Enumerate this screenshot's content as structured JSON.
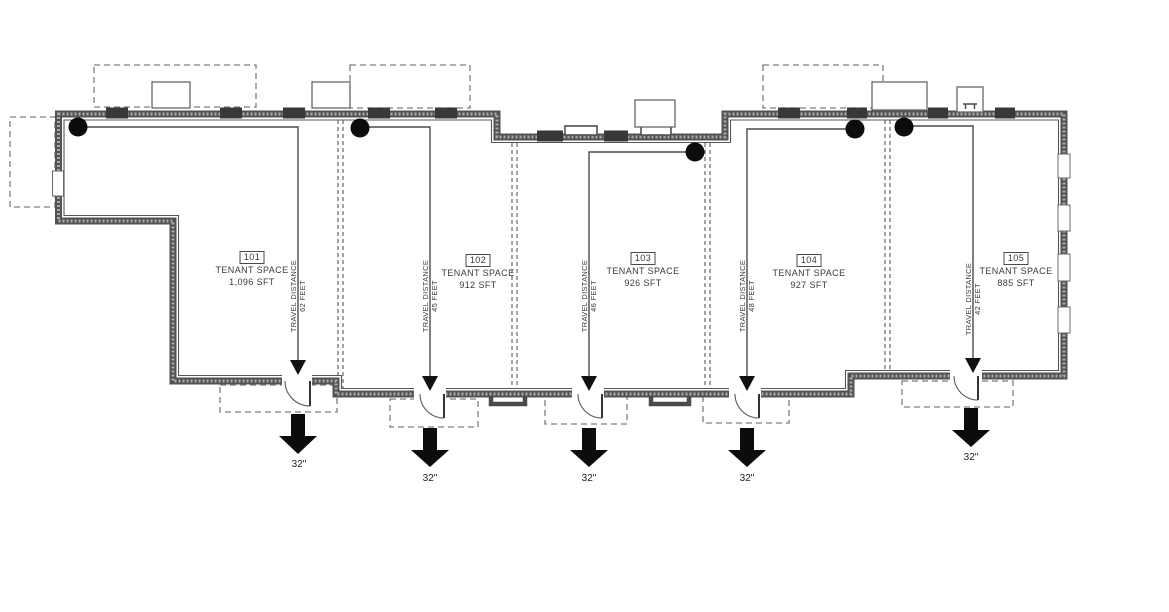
{
  "plan": {
    "spaces": [
      {
        "number": "101",
        "name": "TENANT SPACE",
        "area": "1,096 SFT",
        "travel_label": "TRAVEL DISTANCE",
        "travel_value": "62 FEET",
        "exit_width": "32\""
      },
      {
        "number": "102",
        "name": "TENANT SPACE",
        "area": "912 SFT",
        "travel_label": "TRAVEL DISTANCE",
        "travel_value": "45 FEET",
        "exit_width": "32\""
      },
      {
        "number": "103",
        "name": "TENANT SPACE",
        "area": "926 SFT",
        "travel_label": "TRAVEL DISTANCE",
        "travel_value": "46 FEET",
        "exit_width": "32\""
      },
      {
        "number": "104",
        "name": "TENANT SPACE",
        "area": "927 SFT",
        "travel_label": "TRAVEL DISTANCE",
        "travel_value": "48 FEET",
        "exit_width": "32\""
      },
      {
        "number": "105",
        "name": "TENANT SPACE",
        "area": "885 SFT",
        "travel_label": "TRAVEL DISTANCE",
        "travel_value": "42 FEET",
        "exit_width": "32\""
      }
    ],
    "colors": {
      "wall": "#525252",
      "wall_dark": "#353535",
      "line": "#4a4a4a",
      "dashed": "#7d7d7d",
      "marker": "#0c0c0c",
      "background": "#ffffff"
    }
  }
}
